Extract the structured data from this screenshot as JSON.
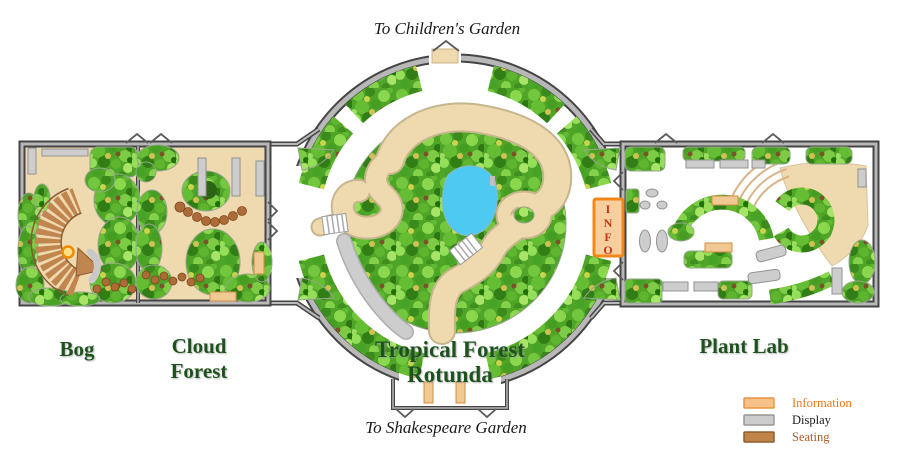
{
  "exits": {
    "top": "To Children's Garden",
    "bottom": "To Shakespeare Garden"
  },
  "rooms": {
    "bog": {
      "label": "Bog"
    },
    "cloud_forest": {
      "line1": "Cloud",
      "line2": "Forest"
    },
    "rotunda": {
      "line1": "Tropical Forest",
      "line2": "Rotunda"
    },
    "plant_lab": {
      "label": "Plant Lab"
    }
  },
  "info_sign": {
    "letters": [
      "I",
      "N",
      "F",
      "O"
    ],
    "fill": "#F7CF9E",
    "border": "#F28718",
    "letter_color": "#C23517"
  },
  "legend": {
    "items": [
      {
        "label": "Information",
        "swatch": "#F7C289",
        "swatch_border": "#E89540",
        "label_color": "#E5761B"
      },
      {
        "label": "Display",
        "swatch": "#CCCCCC",
        "swatch_border": "#979797",
        "label_color": "#1A1A1A"
      },
      {
        "label": "Seating",
        "swatch": "#C08449",
        "swatch_border": "#8B5E2F",
        "label_color": "#B05A20"
      }
    ]
  },
  "colors": {
    "foliage_base": "#4FA527",
    "path_tan": "#EFD9AE",
    "pond": "#4EC9F2",
    "wall_gray": "#454545",
    "boardwalk_brown": "#C1854F",
    "room_label_green": "#1F521F",
    "exit_label_color": "#1A1A1A"
  }
}
